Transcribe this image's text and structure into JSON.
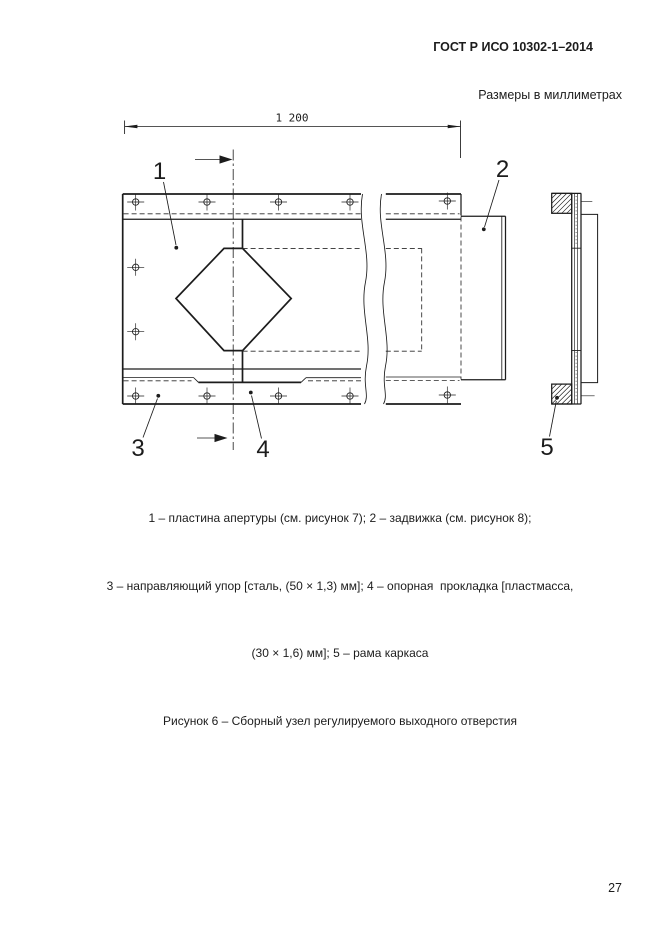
{
  "page": {
    "header": "ГОСТ Р ИСО 10302-1–2014",
    "units_note": "Размеры в миллиметрах",
    "page_number": "27"
  },
  "figure": {
    "dimension": "1 200",
    "callouts": {
      "c1": "1",
      "c2": "2",
      "c3": "3",
      "c4": "4",
      "c5": "5"
    },
    "legend": [
      "1 – пластина апертуры (см. рисунок 7); 2 – задвижка (см. рисунок 8);",
      "3 – направляющий упор [сталь, (50 × 1,3) мм]; 4 – опорная  прокладка [пластмасса,",
      "(30 × 1,6) мм]; 5 – рама каркаса"
    ],
    "title": "Рисунок 6 – Сборный узел регулируемого выходного отверстия"
  },
  "colors": {
    "line": "#1c1c1c",
    "background": "#ffffff"
  }
}
